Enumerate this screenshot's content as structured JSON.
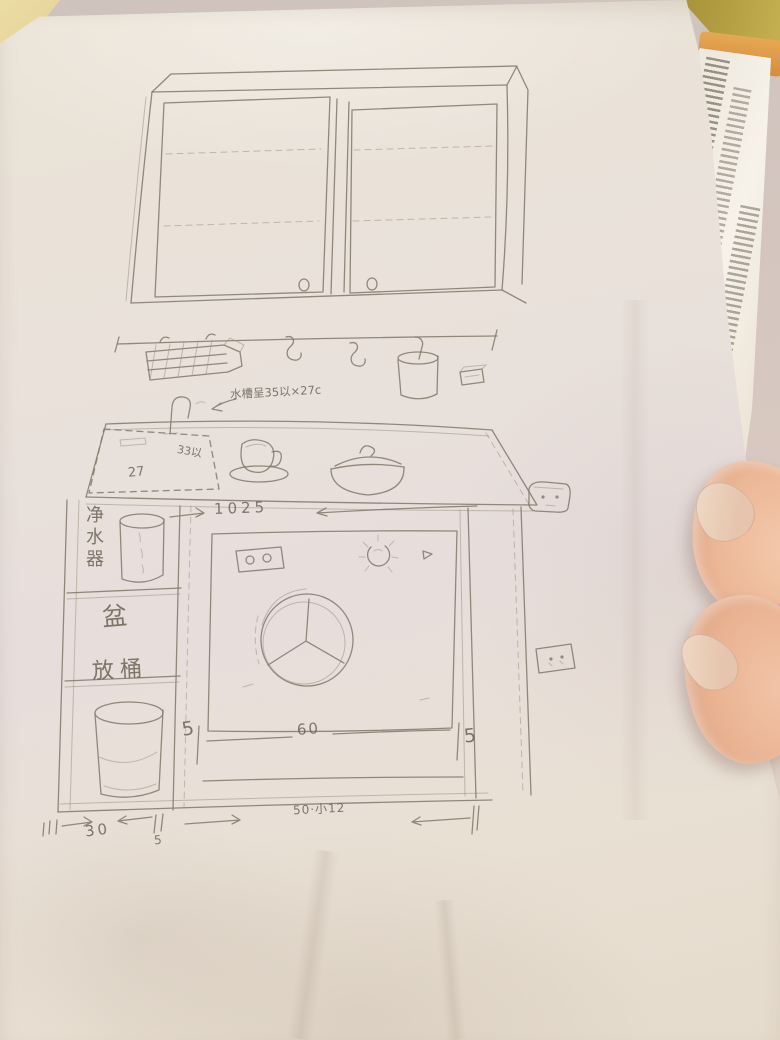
{
  "labels": {
    "sink_note": "水槽呈35以×27c",
    "sink_width": "33以",
    "sink_depth": "27",
    "counter_width": "1025",
    "washer_width": "60",
    "gap_left": "5",
    "gap_right": "5",
    "col_width": "30",
    "divider_width": "5",
    "bottom_width": "50·小12",
    "compartment_top": "净水器",
    "compartment_mid": "盆",
    "compartment_bottom": "放桶"
  },
  "colors": {
    "pencil": "#847b6d",
    "paper": "#e8e1d8",
    "skin": "#ecb897",
    "table_olive": "#b3a040",
    "book_page": "#f4f0e8",
    "ink_label": "#6e6759"
  },
  "sketch_parts": {
    "wall_cabinet": "two-door wall cabinet with dashed shelf lines and round knobs",
    "hanging_rail": "rail with wire basket, two s-hooks, hanging cup, small box",
    "counter": "countertop with dashed sink, faucet, cup on saucer, lidded bowl",
    "base_cabinet": "base cabinet with purifier, basin and bucket compartments",
    "washing_machine": "front-load washer with control panel, dial and round door",
    "sockets": "two wall power sockets"
  }
}
